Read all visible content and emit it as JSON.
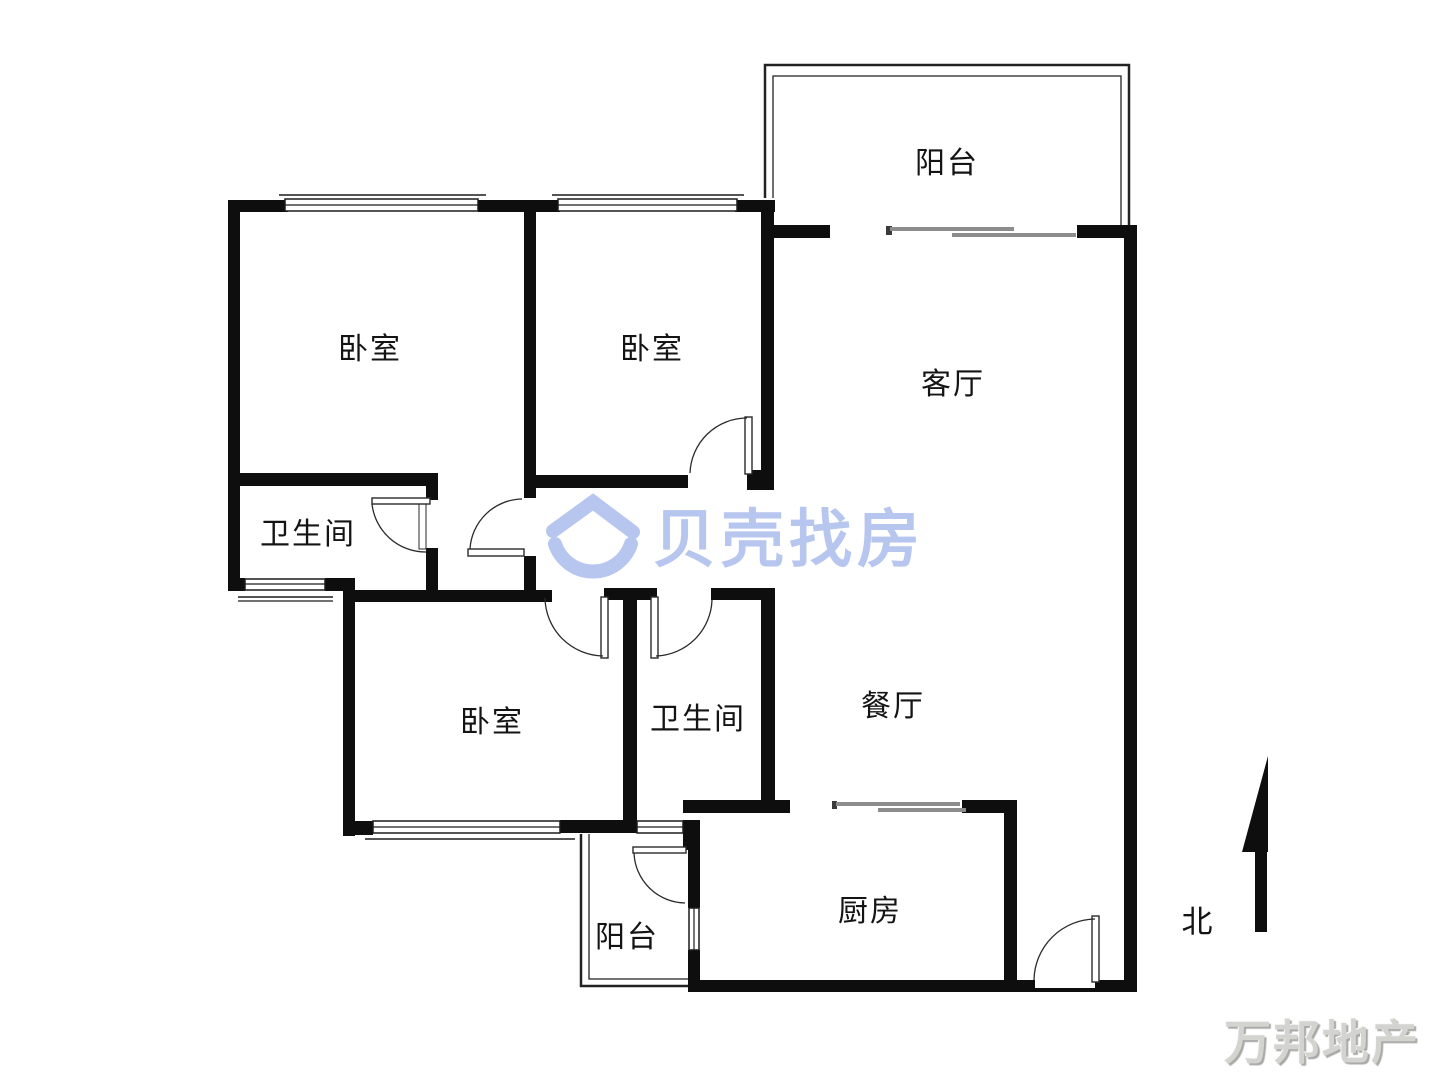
{
  "floorplan": {
    "rooms": [
      {
        "id": "balcony-top",
        "label": "阳台",
        "cx": 947,
        "cy": 160
      },
      {
        "id": "bedroom-1",
        "label": "卧室",
        "cx": 370,
        "cy": 346
      },
      {
        "id": "bedroom-2",
        "label": "卧室",
        "cx": 652,
        "cy": 346
      },
      {
        "id": "living-room",
        "label": "客厅",
        "cx": 953,
        "cy": 381
      },
      {
        "id": "bathroom-1",
        "label": "卫生间",
        "cx": 308,
        "cy": 531
      },
      {
        "id": "bedroom-3",
        "label": "卧室",
        "cx": 492,
        "cy": 719
      },
      {
        "id": "bathroom-2",
        "label": "卫生间",
        "cx": 698,
        "cy": 716
      },
      {
        "id": "dining-room",
        "label": "餐厅",
        "cx": 893,
        "cy": 703
      },
      {
        "id": "kitchen",
        "label": "厨房",
        "cx": 870,
        "cy": 908
      },
      {
        "id": "balcony-bottom",
        "label": "阳台",
        "cx": 627,
        "cy": 934
      }
    ],
    "compass": {
      "label": "北"
    },
    "colors": {
      "wall": "#0e0e0e",
      "sliding_door": "#8d8d8d",
      "logo_blue": "#b7c6ef",
      "watermark_gray": "#d3d3d0"
    }
  },
  "watermarks": {
    "beike_logo_text": "贝壳找房",
    "agency_text": "万邦地产"
  }
}
